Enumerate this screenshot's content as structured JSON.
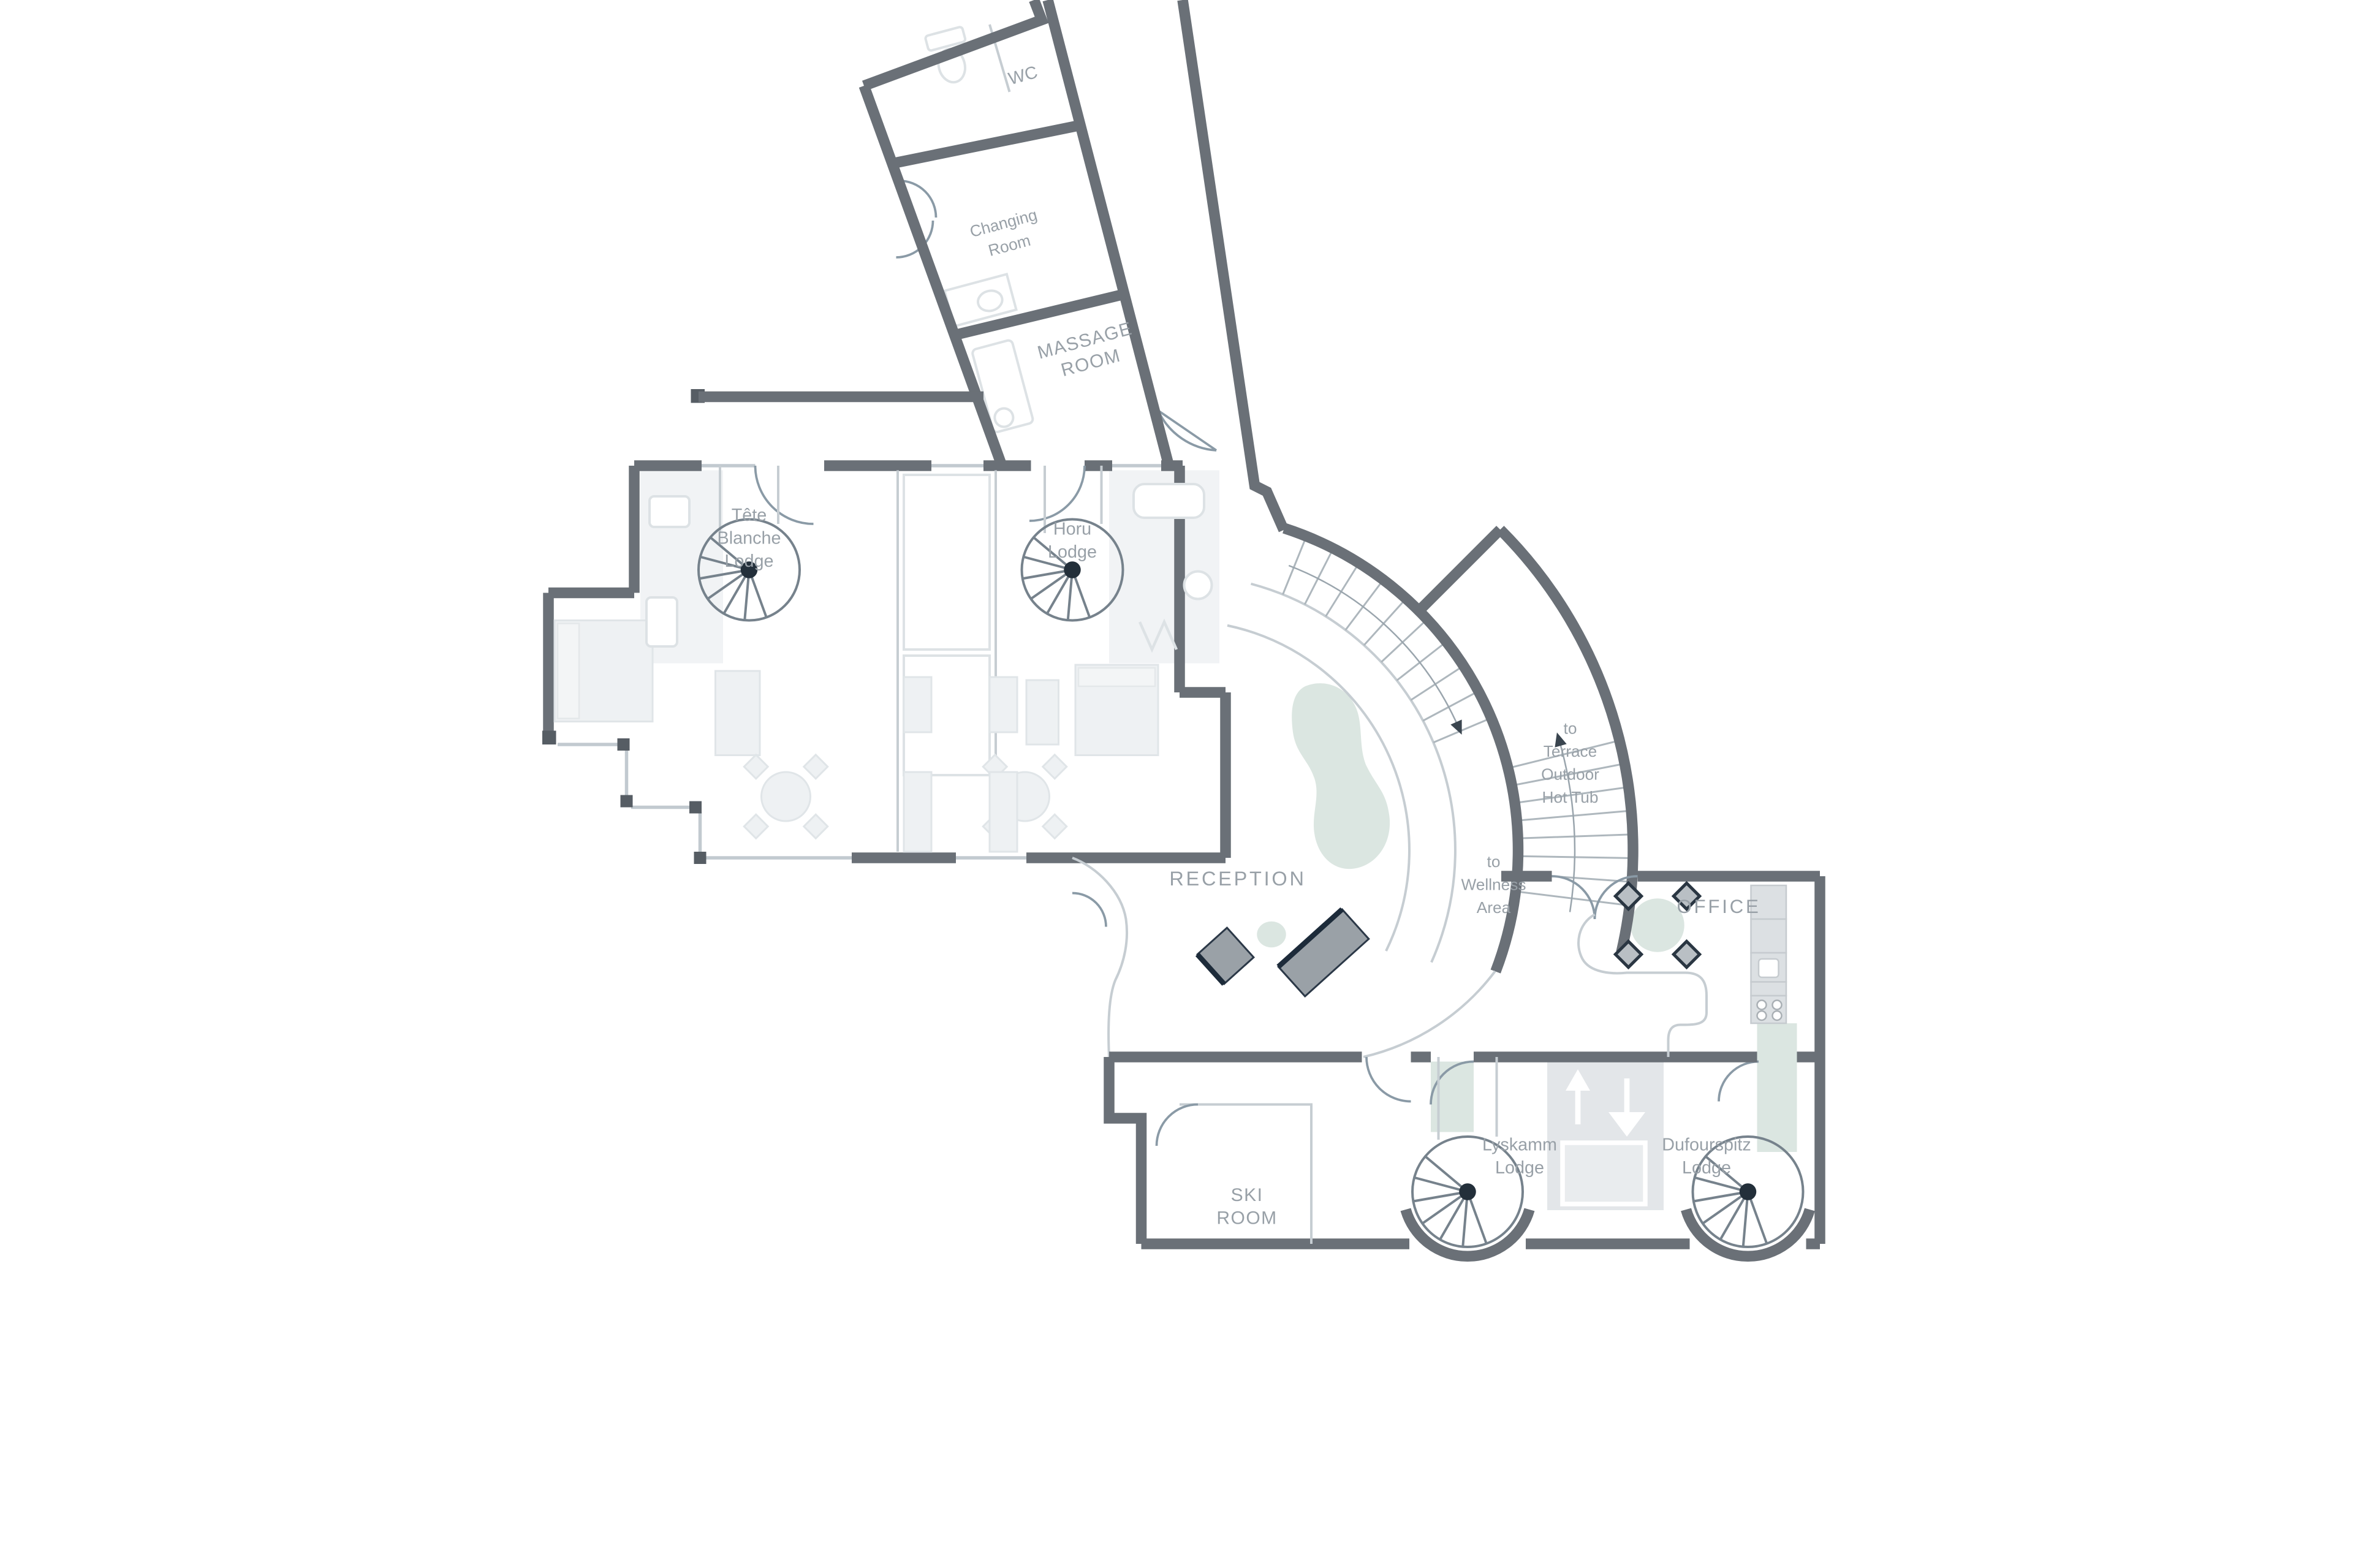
{
  "plan": {
    "type": "hotel-lodge-floor-plan",
    "colors": {
      "wall": "#6a7077",
      "thin_line": "#c6cdd2",
      "accent_green": "#dbe6e1",
      "furniture": "#eef1f3",
      "desk_gray": "#9aa1a7",
      "desk_edge": "#1d2b3a",
      "label_gray": "#98a0a7",
      "stair": "#76828c",
      "elevator_shaft": "#e3e6e9"
    },
    "rooms": [
      {
        "id": "wc",
        "lines": [
          "WC"
        ]
      },
      {
        "id": "changing-room",
        "lines": [
          "Changing",
          "Room"
        ]
      },
      {
        "id": "massage-room",
        "lines": [
          "MASSAGE",
          "ROOM"
        ]
      },
      {
        "id": "tete-blanche-lodge",
        "lines": [
          "Tête",
          "Blanche",
          "Lodge"
        ]
      },
      {
        "id": "horu-lodge",
        "lines": [
          "Horu",
          "Lodge"
        ]
      },
      {
        "id": "reception",
        "lines": [
          "RECEPTION"
        ]
      },
      {
        "id": "office",
        "lines": [
          "OFFICE"
        ]
      },
      {
        "id": "ski-room",
        "lines": [
          "SKI",
          "ROOM"
        ]
      },
      {
        "id": "lyskamm-lodge",
        "lines": [
          "Lyskamm",
          "Lodge"
        ]
      },
      {
        "id": "dufourspitz-lodge",
        "lines": [
          "Dufourspitz",
          "Lodge"
        ]
      }
    ],
    "annotations": [
      {
        "id": "to-wellness-area",
        "lines": [
          "to",
          "Wellness",
          "Area"
        ]
      },
      {
        "id": "to-terrace-hot-tub",
        "lines": [
          "to",
          "Terrace",
          "Outdoor",
          "Hot Tub"
        ]
      }
    ]
  }
}
